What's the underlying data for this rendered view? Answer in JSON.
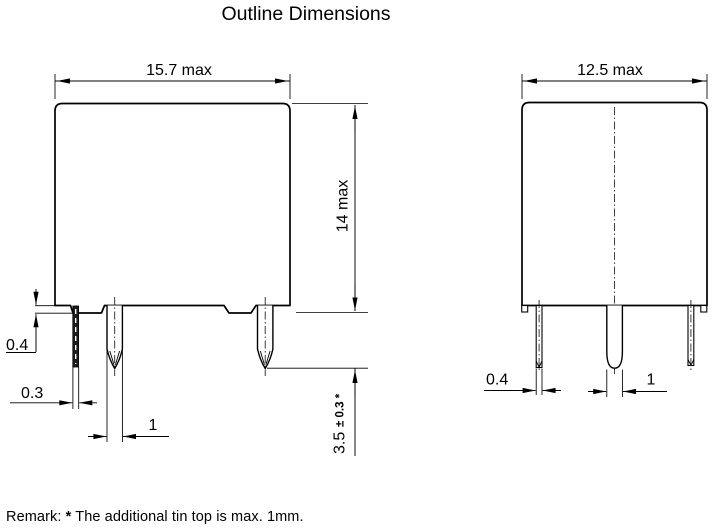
{
  "title": "Outline Dimensions",
  "front_view": {
    "width": "15.7 max",
    "height": "14 max",
    "terminal_standoff": "0.4",
    "terminal_thickness": "0.3",
    "terminal_width": "1",
    "terminal_length": "3.5",
    "terminal_length_tolerance": "± 0.3 *"
  },
  "side_view": {
    "width": "12.5 max",
    "terminal_thickness": "0.4",
    "terminal_width": "1"
  },
  "remark": {
    "label": "Remark:",
    "star": "*",
    "text": "The additional tin top is max. 1mm."
  }
}
